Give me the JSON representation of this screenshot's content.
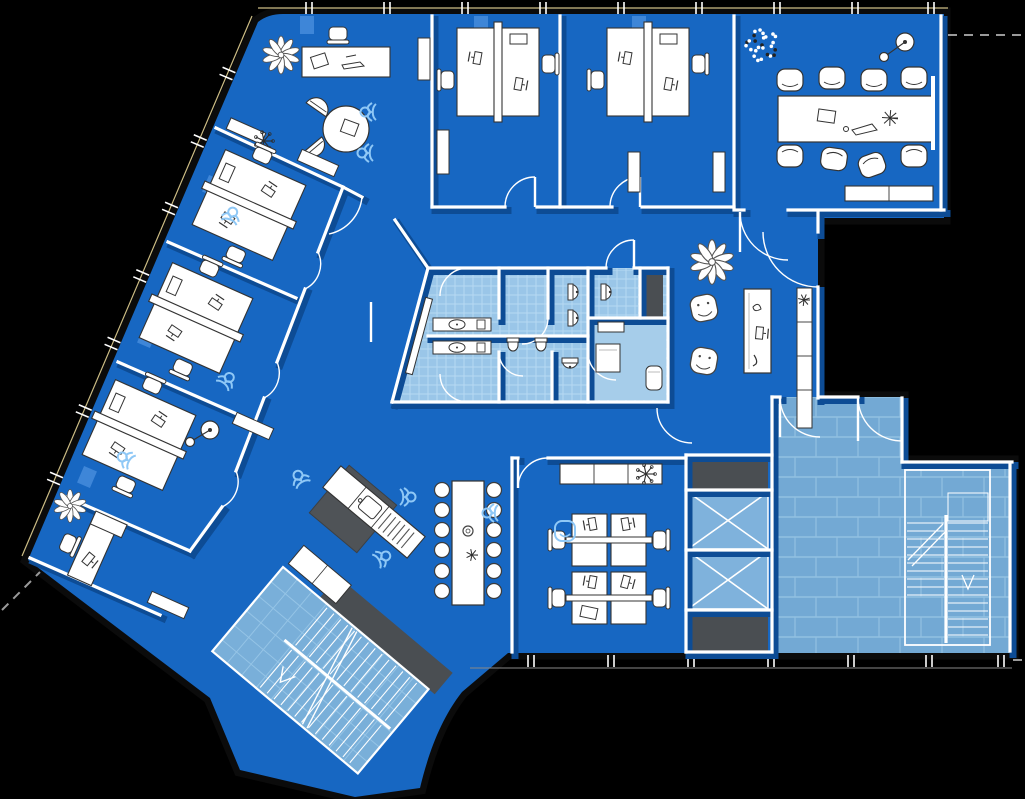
{
  "meta": {
    "title": "Office floor plan blueprint",
    "type": "floor-plan"
  },
  "canvas": {
    "w": 1025,
    "h": 799
  },
  "colors": {
    "bg": "#000000",
    "floor": "#1767C2",
    "floor_light": "#3E86D8",
    "shadow": "#0D4C95",
    "wall": "#FFFFFF",
    "band": "#0B0B0B",
    "band_line": "#CDBD85",
    "tile_bath": "#9AC6E8",
    "tile_bath_grid": "#B7D9F2",
    "tile_lobby": "#73A9D4",
    "tile_lobby_grid": "#92C1E2",
    "tile_stair": "#79AFD9",
    "tile_stair_grid": "#95C4E6",
    "rest_room": "#A6CDEA",
    "dark": "#4A4E52",
    "dark2": "#4F5357",
    "outline": "#333333",
    "sketch": "#8FC8F6",
    "dash": "#9A9A9A"
  },
  "floor_outline": "M 283 14 L 944 14 L 944 218 L 818 218 L 818 398 L 902 398 L 902 462 L 1012 462 L 1012 653 L 508 653 L 462 692 C 440 720 428 755 420 788 L 355 797 L 240 770 L 210 698 L 28 560 L 258 22 Q 268 14 283 14 Z",
  "band": {
    "top_line": [
      258,
      8,
      948,
      8
    ],
    "diag_line": [
      252,
      16,
      22,
      556
    ],
    "bottom_line": [
      470,
      668,
      1012,
      668
    ],
    "top_ticks": [
      306,
      384,
      462,
      540,
      618,
      696,
      774,
      852,
      928
    ],
    "bottom_ticks": [
      528,
      608,
      688,
      768,
      848,
      926,
      998
    ],
    "diag_tick_ts": [
      0.1,
      0.225,
      0.35,
      0.475,
      0.6,
      0.725,
      0.85
    ]
  },
  "pilasters": [
    [
      300,
      16,
      14,
      18,
      0
    ],
    [
      474,
      16,
      14,
      18,
      0
    ],
    [
      632,
      16,
      14,
      18,
      0
    ],
    [
      205,
      177,
      14,
      18,
      23
    ],
    [
      140,
      328,
      14,
      18,
      23
    ],
    [
      80,
      468,
      14,
      18,
      23
    ]
  ],
  "tiles": {
    "bath_poly": "428,268 668,268 668,402 392,402",
    "wc_rect": [
      590,
      270,
      48,
      46
    ],
    "rest_rect": [
      590,
      320,
      76,
      80
    ],
    "lobby_poly": "774,397 902,397 902,462 1012,462 1012,653 774,653"
  },
  "walls": [
    [
      432,
      16,
      432,
      207
    ],
    [
      560,
      16,
      560,
      207
    ],
    [
      734,
      16,
      734,
      207
    ],
    [
      432,
      207,
      505,
      207
    ],
    [
      537,
      207,
      612,
      207
    ],
    [
      642,
      207,
      734,
      207
    ],
    [
      734,
      210,
      744,
      210
    ],
    [
      788,
      210,
      944,
      210
    ],
    [
      941,
      16,
      941,
      210
    ],
    [
      818,
      212,
      818,
      232
    ],
    [
      818,
      287,
      818,
      398
    ],
    [
      216,
      128,
      343,
      187
    ],
    [
      168,
      242,
      296,
      298
    ],
    [
      118,
      362,
      246,
      418
    ],
    [
      62,
      495,
      190,
      551
    ],
    [
      343,
      187,
      318,
      252
    ],
    [
      305,
      289,
      277,
      362
    ],
    [
      264,
      398,
      236,
      471
    ],
    [
      222,
      507,
      190,
      551
    ],
    [
      343,
      187,
      362,
      197
    ],
    [
      395,
      220,
      428,
      268
    ],
    [
      30,
      558,
      160,
      615
    ],
    [
      428,
      268,
      606,
      268
    ],
    [
      634,
      268,
      668,
      268
    ],
    [
      668,
      268,
      668,
      402
    ],
    [
      392,
      402,
      668,
      402
    ],
    [
      428,
      268,
      392,
      402
    ],
    [
      499,
      268,
      499,
      318
    ],
    [
      499,
      352,
      499,
      402
    ],
    [
      548,
      268,
      548,
      318
    ],
    [
      552,
      352,
      552,
      402
    ],
    [
      588,
      268,
      588,
      402
    ],
    [
      588,
      318,
      668,
      318
    ],
    [
      640,
      268,
      640,
      318
    ],
    [
      428,
      336,
      588,
      336
    ],
    [
      512,
      458,
      512,
      652
    ],
    [
      512,
      458,
      518,
      458
    ],
    [
      548,
      458,
      686,
      458
    ],
    [
      686,
      455,
      686,
      652
    ],
    [
      686,
      455,
      772,
      455
    ],
    [
      686,
      652,
      772,
      652
    ],
    [
      686,
      490,
      772,
      490
    ],
    [
      686,
      550,
      772,
      550
    ],
    [
      686,
      610,
      772,
      610
    ],
    [
      772,
      397,
      772,
      652
    ],
    [
      772,
      397,
      780,
      397
    ],
    [
      820,
      397,
      858,
      397
    ],
    [
      902,
      398,
      902,
      462
    ],
    [
      902,
      462,
      1012,
      462
    ],
    [
      1010,
      464,
      1010,
      651
    ]
  ],
  "door_leaves": [
    [
      535,
      177,
      535,
      207
    ],
    [
      640,
      177,
      640,
      207
    ],
    [
      740,
      212,
      740,
      252
    ],
    [
      634,
      240,
      634,
      268
    ],
    [
      518,
      458,
      518,
      488
    ],
    [
      780,
      397,
      780,
      437
    ],
    [
      858,
      397,
      858,
      441
    ],
    [
      371,
      302,
      371,
      342
    ]
  ],
  "door_arcs": [
    "M 535 177 A 30 30 0 0 0 505 207",
    "M 640 177 A 30 30 0 0 0 610 207",
    "M 362 197 A 42 42 0 0 1 329 234",
    "M 740 212 A 48 48 0 0 0 788 260",
    "M 763 232 A 55 55 0 0 0 818 287",
    "M 634 240 A 28 28 0 0 0 606 268",
    "M 318 252 A 28 28 0 0 1 305 289",
    "M 277 362 A 28 28 0 0 1 264 398",
    "M 236 471 A 28 28 0 0 1 222 507",
    "M 518 488 A 30 30 0 0 1 548 458",
    "M 657 408 A 35 35 0 0 0 692 443",
    "M 780 397 A 40 40 0 0 0 820 437",
    "M 858 397 A 44 44 0 0 0 902 441",
    "M 440 296 A 28 28 0 0 1 468 268",
    "M 440 374 A 28 28 0 0 0 468 402",
    "M 548 318 A 26 26 0 0 1 522 344",
    "M 499 352 A 24 24 0 0 0 523 376",
    "M 588 352 A 28 28 0 0 0 616 380"
  ],
  "dark_blocks": [
    {
      "x": 688,
      "y": 457,
      "w": 80,
      "h": 33,
      "r": 0,
      "name": "elevator-shaft-wall-top"
    },
    {
      "x": 688,
      "y": 611,
      "w": 80,
      "h": 41,
      "r": 0,
      "name": "elevator-shaft-wall-bottom"
    },
    {
      "x": 643,
      "y": 274,
      "w": 20,
      "h": 44,
      "r": 0,
      "name": "wc-locker"
    }
  ],
  "elevators": [
    {
      "x": 688,
      "y": 492,
      "w": 80,
      "h": 57
    },
    {
      "x": 688,
      "y": 551,
      "w": 80,
      "h": 58
    }
  ],
  "stair_lobby": {
    "x": 905,
    "y": 470,
    "w": 85,
    "h": 175,
    "cx": 946,
    "tread_top": 523,
    "tread_step": 8,
    "tread_bot_l": 595,
    "tread_bot_r": 641
  },
  "stair_bl": {
    "tx": 283,
    "ty": 567,
    "rot": 40,
    "w": 190,
    "h": 110
  },
  "furniture": [
    {
      "t": "plantFlower",
      "x": 281,
      "y": 55,
      "s": 1.15,
      "name": "plant"
    },
    {
      "t": "deskLounge",
      "x": 302,
      "y": 47,
      "name": "lounge-desk"
    },
    {
      "t": "roundTable",
      "x": 346,
      "y": 129,
      "name": "round-table"
    },
    {
      "t": "chairD",
      "x": 320,
      "y": 104,
      "r": 35
    },
    {
      "t": "chairD",
      "x": 317,
      "y": 150,
      "r": 140
    },
    {
      "t": "sketch",
      "x": 367,
      "y": 112,
      "r": -90
    },
    {
      "t": "sketch",
      "x": 364,
      "y": 153,
      "r": -90
    },
    {
      "t": "cabinet",
      "x": 246,
      "y": 131,
      "w": 38,
      "h": 12,
      "r": 24
    },
    {
      "t": "plantSketch",
      "x": 264,
      "y": 141
    },
    {
      "t": "cabinet",
      "x": 424,
      "y": 59,
      "w": 12,
      "h": 42,
      "r": 0
    },
    {
      "t": "deskPair",
      "x": 249,
      "y": 205,
      "r": -66,
      "name": "office-desk-pair"
    },
    {
      "t": "sketch",
      "x": 232,
      "y": 214,
      "r": 20
    },
    {
      "t": "cabinet",
      "x": 318,
      "y": 163,
      "w": 40,
      "h": 12,
      "r": 24
    },
    {
      "t": "deskPair",
      "x": 196,
      "y": 318,
      "r": -66,
      "name": "office-desk-pair"
    },
    {
      "t": "sketch",
      "x": 228,
      "y": 379,
      "r": 40
    },
    {
      "t": "deskPair",
      "x": 139,
      "y": 435,
      "r": -66,
      "name": "office-desk-pair"
    },
    {
      "t": "lampLine",
      "x": 210,
      "y": 430,
      "dx": -20,
      "dy": 12
    },
    {
      "t": "cabinet",
      "x": 253,
      "y": 426,
      "w": 40,
      "h": 12,
      "r": 24
    },
    {
      "t": "sketch",
      "x": 124,
      "y": 458,
      "r": -60
    },
    {
      "t": "deskSingle",
      "x": 92,
      "y": 552,
      "r": -66,
      "name": "office-desk"
    },
    {
      "t": "plantFlower",
      "x": 70,
      "y": 506,
      "s": 1.0,
      "name": "plant"
    },
    {
      "t": "cabinet",
      "x": 168,
      "y": 605,
      "w": 40,
      "h": 12,
      "r": 24
    },
    {
      "t": "deskPair",
      "x": 498,
      "y": 72,
      "r": 0,
      "name": "office-desk-pair"
    },
    {
      "t": "cabinet",
      "x": 443,
      "y": 152,
      "w": 12,
      "h": 44,
      "r": 0
    },
    {
      "t": "deskPair",
      "x": 648,
      "y": 72,
      "r": 0,
      "name": "office-desk-pair"
    },
    {
      "t": "cabinet",
      "x": 634,
      "y": 172,
      "w": 12,
      "h": 40,
      "r": 0
    },
    {
      "t": "cabinet",
      "x": 719,
      "y": 172,
      "w": 12,
      "h": 40,
      "r": 0
    },
    {
      "t": "confTable",
      "x": 778,
      "y": 96,
      "name": "conference-table"
    },
    {
      "t": "confChair",
      "x": 790,
      "y": 80,
      "r": 180
    },
    {
      "t": "confChair",
      "x": 832,
      "y": 78,
      "r": 180
    },
    {
      "t": "confChair",
      "x": 874,
      "y": 80,
      "r": 180
    },
    {
      "t": "confChair",
      "x": 914,
      "y": 78,
      "r": 180
    },
    {
      "t": "confChair",
      "x": 790,
      "y": 156,
      "r": 0
    },
    {
      "t": "confChair",
      "x": 834,
      "y": 159,
      "r": 8
    },
    {
      "t": "confChair",
      "x": 872,
      "y": 165,
      "r": -20
    },
    {
      "t": "confChair",
      "x": 914,
      "y": 156,
      "r": 0
    },
    {
      "t": "plantDots",
      "x": 762,
      "y": 45,
      "name": "plant"
    },
    {
      "t": "lampLine",
      "x": 905,
      "y": 42,
      "dx": -21,
      "dy": 15
    },
    {
      "t": "boardLine",
      "x1": 933,
      "y1": 76,
      "x2": 933,
      "y2": 150,
      "name": "whiteboard"
    },
    {
      "t": "sideboard",
      "x": 845,
      "y": 186,
      "name": "sideboard"
    },
    {
      "t": "sink",
      "x": 433,
      "y": 318
    },
    {
      "t": "sink",
      "x": 433,
      "y": 341
    },
    {
      "t": "cabinet",
      "x": 419,
      "y": 336,
      "w": 7,
      "h": 78,
      "r": 15
    },
    {
      "t": "toilet",
      "x": 571,
      "y": 292,
      "r": 0
    },
    {
      "t": "toilet",
      "x": 571,
      "y": 318,
      "r": 0
    },
    {
      "t": "toilet",
      "x": 570,
      "y": 361,
      "r": 90
    },
    {
      "t": "toilet",
      "x": 604,
      "y": 292,
      "r": 0
    },
    {
      "t": "urinal",
      "x": 513,
      "y": 346
    },
    {
      "t": "urinal",
      "x": 541,
      "y": 346
    },
    {
      "t": "restTable",
      "x": 596,
      "y": 344
    },
    {
      "t": "cylinder",
      "x": 654,
      "y": 378
    },
    {
      "t": "smallShelf",
      "x": 598,
      "y": 322
    },
    {
      "t": "recDesk",
      "x": 744,
      "y": 289,
      "name": "reception-desk"
    },
    {
      "t": "shelfCol",
      "x": 797,
      "y": 288,
      "name": "shelf-column"
    },
    {
      "t": "plantFlower",
      "x": 712,
      "y": 262,
      "s": 1.35,
      "name": "plant"
    },
    {
      "t": "armchair",
      "x": 704,
      "y": 308,
      "r": -12
    },
    {
      "t": "armchair",
      "x": 704,
      "y": 361,
      "r": 10
    },
    {
      "t": "island",
      "x": 353,
      "y": 509,
      "r": 40,
      "name": "kitchen-island"
    },
    {
      "t": "kitchen",
      "x": 374,
      "y": 512,
      "r": 40,
      "name": "kitchen-counter"
    },
    {
      "t": "sketch",
      "x": 409,
      "y": 497,
      "r": 90
    },
    {
      "t": "sketch",
      "x": 384,
      "y": 557,
      "r": 60
    },
    {
      "t": "sketch",
      "x": 299,
      "y": 477,
      "r": -30
    },
    {
      "t": "longTable",
      "x": 452,
      "y": 481,
      "name": "break-table"
    },
    {
      "t": "stool",
      "x": 442,
      "y": 490
    },
    {
      "t": "stool",
      "x": 442,
      "y": 510
    },
    {
      "t": "stool",
      "x": 442,
      "y": 530
    },
    {
      "t": "stool",
      "x": 442,
      "y": 550
    },
    {
      "t": "stool",
      "x": 442,
      "y": 571
    },
    {
      "t": "stool",
      "x": 442,
      "y": 591
    },
    {
      "t": "stool",
      "x": 494,
      "y": 490
    },
    {
      "t": "stool",
      "x": 494,
      "y": 510
    },
    {
      "t": "stool",
      "x": 494,
      "y": 530
    },
    {
      "t": "stool",
      "x": 494,
      "y": 550
    },
    {
      "t": "stool",
      "x": 494,
      "y": 571
    },
    {
      "t": "stool",
      "x": 494,
      "y": 591
    },
    {
      "t": "sketch",
      "x": 489,
      "y": 513,
      "r": -90
    },
    {
      "t": "shelf",
      "x": 560,
      "y": 464,
      "name": "office-shelf"
    },
    {
      "t": "plantSketch",
      "x": 646,
      "y": 474
    },
    {
      "t": "deskQuad",
      "x": 609,
      "y": 569,
      "name": "quad-desk-cluster"
    },
    {
      "t": "sketchChair",
      "x": 565,
      "y": 531
    }
  ],
  "dashes": [
    [
      948,
      35,
      1025,
      35
    ],
    [
      1013,
      660,
      1025,
      660
    ],
    [
      2,
      610,
      40,
      572
    ]
  ]
}
